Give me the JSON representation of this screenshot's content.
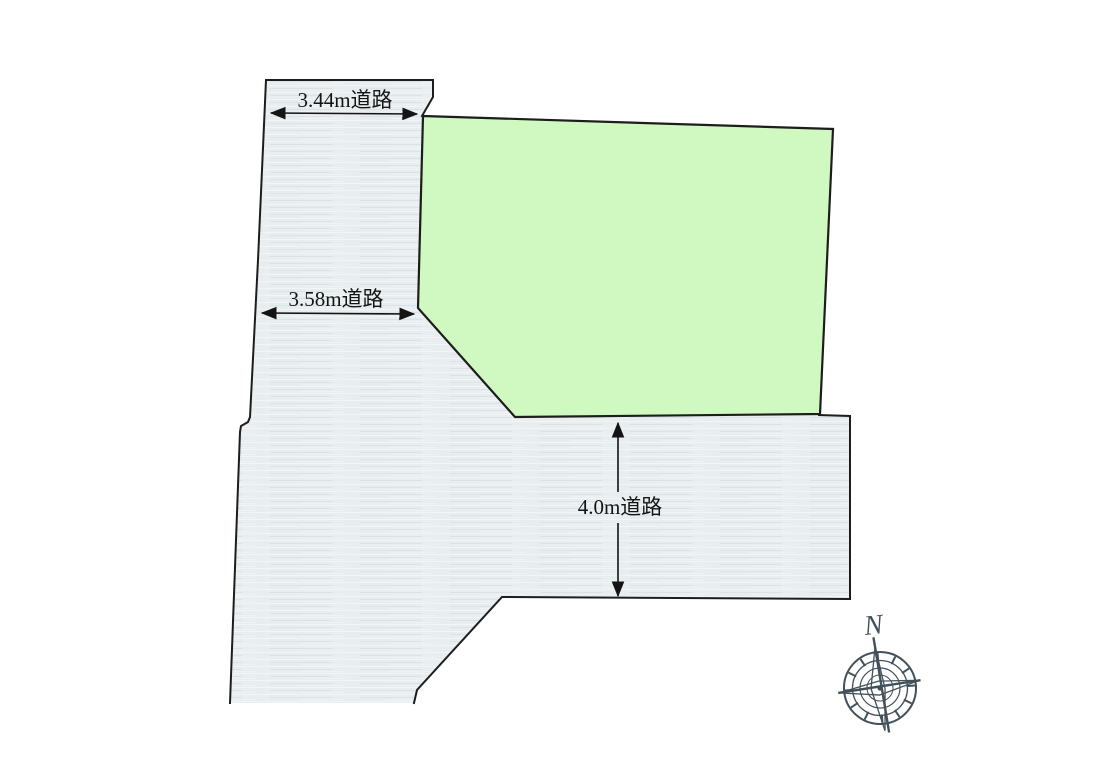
{
  "diagram": {
    "type": "land-plot-layout",
    "background": "#ffffff",
    "plot": {
      "fill": "#cff9c0",
      "outline": "#1d1d1b",
      "points": "423,116 833,129 820,414 515,417 418,308"
    },
    "roads": {
      "fill_base": "#e8edef",
      "outline": "#1d1d1b",
      "area_points": "266,80 433,80 433,97 422,116 418,308 515,417 820,414 850,416 850,600 502,597 417,690 414,703 230,703 240,432 241,426 248,422 250,417 258,260",
      "border_left_points": "422,116 433,97 433,80 266,80 258,260 250,417 248,422 241,426 240,432 230,703",
      "border_bottom_points": "414,703 417,690 502,597 850,599 850,416 819,415"
    },
    "dimensions": [
      {
        "label": "3.44m道路",
        "line_points": "271,113 417,114"
      },
      {
        "label": "3.58m道路",
        "line_points": "262,313 414,314"
      },
      {
        "label": "4.0m道路",
        "line_up_points": "618,492 618,423",
        "line_down_points": "618,523 618,596"
      }
    ],
    "compass": {
      "label": "N",
      "color": "#42505a"
    },
    "dimension_text_color": "#141414"
  }
}
